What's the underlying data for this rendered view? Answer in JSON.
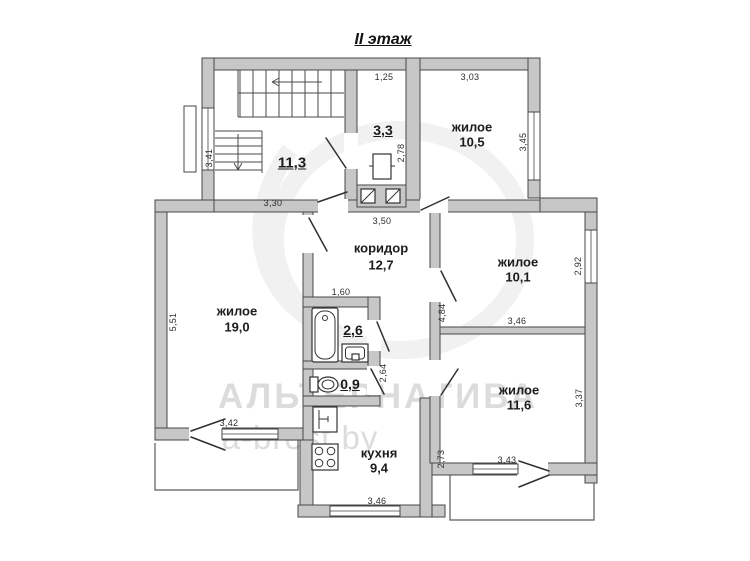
{
  "title": "II этаж",
  "watermark": {
    "brand": "АЛЬТЕРНАТИВА",
    "site": "a-brest.by"
  },
  "rooms": {
    "hall": {
      "area": "11,3"
    },
    "small_room": {
      "area": "3,3"
    },
    "living_top": {
      "name": "жилое",
      "area": "10,5"
    },
    "corridor": {
      "name": "коридор",
      "area": "12,7"
    },
    "living_right": {
      "name": "жилое",
      "area": "10,1"
    },
    "living_left": {
      "name": "жилое",
      "area": "19,0"
    },
    "bathroom": {
      "area": "2,6"
    },
    "wc": {
      "area": "0,9"
    },
    "living_bottom": {
      "name": "жилое",
      "area": "11,6"
    },
    "kitchen": {
      "name": "кухня",
      "area": "9,4"
    }
  },
  "dims": [
    "1,25",
    "3,03",
    "3,45",
    "2,78",
    "3,41",
    "3,30",
    "3,50",
    "5,51",
    "2,92",
    "1,60",
    "4,84",
    "3,46",
    "2,64",
    "3,37",
    "3,42",
    "2,73",
    "3,43",
    "3,46"
  ],
  "colors": {
    "wall_fill": "#c7c7c7",
    "line": "#474747",
    "watermark": "#dcdcdc"
  }
}
